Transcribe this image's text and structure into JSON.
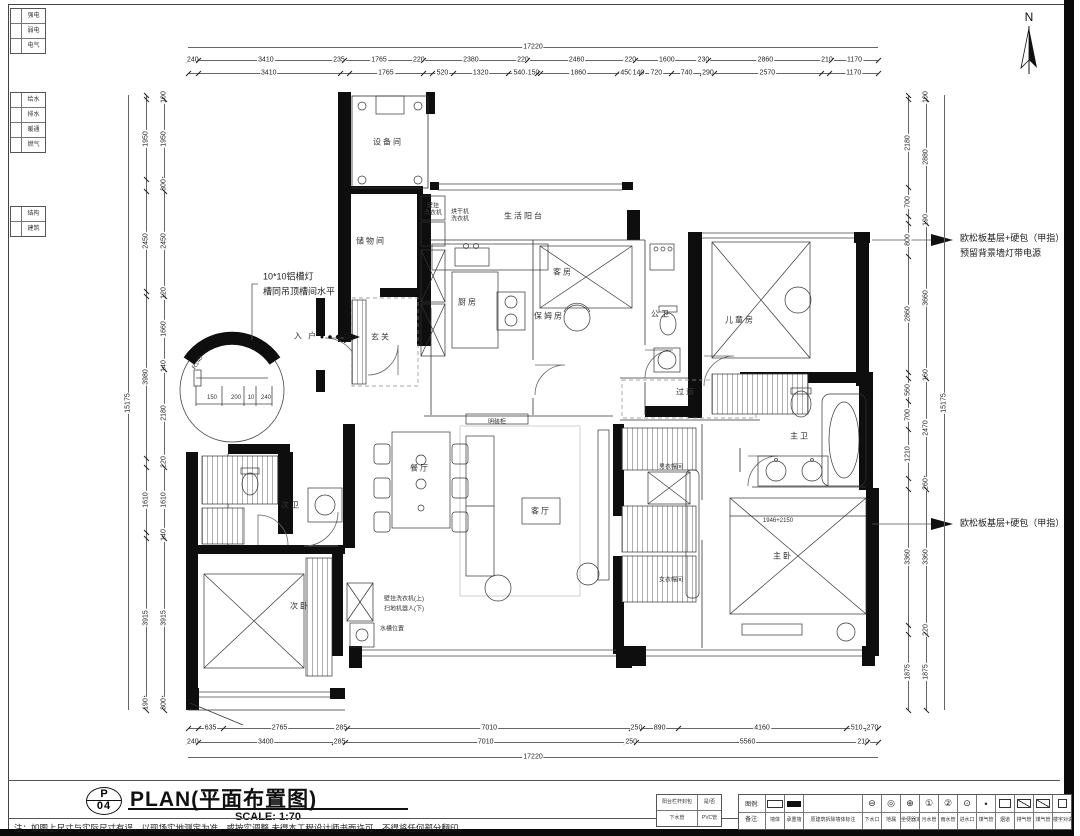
{
  "colors": {
    "paper": "#ffffff",
    "ink": "#111111",
    "line": "#555555"
  },
  "north": {
    "label": "N"
  },
  "title_block": {
    "sheet_letter": "P",
    "sheet_no": "04",
    "title": "PLAN(平面布置图)",
    "scale": "SCALE: 1:70"
  },
  "note": "注：如图上尺寸与实际尺寸有误，以现场实地测定为准，或按实调整.未得本工程设计师书面许可，不得将任何部分翻印。",
  "mini_table": {
    "rows": [
      [
        "阳台栏杆封包",
        "是/否"
      ],
      [
        "下水管",
        "PVC管"
      ]
    ]
  },
  "legend": {
    "prefix_top": "图例:",
    "prefix_bottom": "备注:",
    "items": [
      {
        "shape": "sw-wall-outline",
        "label": "墙体"
      },
      {
        "shape": "sw-wall-filled",
        "label": "承重墙"
      },
      {
        "wide": true,
        "label": "原建筑拆除墙体标注"
      },
      {
        "glyph": "⊖",
        "label": "下水口"
      },
      {
        "glyph": "◎",
        "label": "地漏"
      },
      {
        "glyph": "⊕",
        "label": "坐便器定位"
      },
      {
        "glyph": "①",
        "label": "污水管"
      },
      {
        "glyph": "②",
        "label": "雨水管"
      },
      {
        "glyph": "⊙",
        "label": "进水口"
      },
      {
        "glyph": "•",
        "label": "煤气管"
      },
      {
        "shape": "sw-rect",
        "label": "烟道"
      },
      {
        "shape": "sw-rect-diag",
        "label": "排气管"
      },
      {
        "shape": "sw-rect-diag",
        "label": "煤气管"
      },
      {
        "shape": "sw-square-dot",
        "glyph": "",
        "label": "楼宇对讲"
      }
    ]
  },
  "side_tables": [
    {
      "y": 8,
      "rows": [
        "强电",
        "弱电",
        "电气"
      ]
    },
    {
      "y": 92,
      "rows": [
        "给水",
        "排水",
        "暖通",
        "燃气"
      ]
    },
    {
      "y": 206,
      "rows": [
        "结构",
        "建筑"
      ]
    }
  ],
  "callouts": [
    {
      "x": 960,
      "y": 231,
      "lines": [
        "欧松板基层+硬包（甲指）",
        "预留背景墙灯带电源"
      ]
    },
    {
      "x": 960,
      "y": 516,
      "lines": [
        "欧松板基层+硬包（甲指）"
      ]
    }
  ],
  "plan_texts": [
    {
      "t": "设备间",
      "x": 388,
      "y": 142,
      "cls": "room"
    },
    {
      "t": "储物间",
      "x": 371,
      "y": 241,
      "cls": "room"
    },
    {
      "t": "生活阳台",
      "x": 524,
      "y": 216,
      "cls": "room"
    },
    {
      "t": "厨房",
      "x": 468,
      "y": 302,
      "cls": "room"
    },
    {
      "t": "玄关",
      "x": 381,
      "y": 337,
      "cls": "room"
    },
    {
      "t": "客房",
      "x": 563,
      "y": 272,
      "cls": "room"
    },
    {
      "t": "保姆房",
      "x": 549,
      "y": 316,
      "cls": "room"
    },
    {
      "t": "公卫",
      "x": 661,
      "y": 314,
      "cls": "room"
    },
    {
      "t": "儿童房",
      "x": 740,
      "y": 320,
      "cls": "room"
    },
    {
      "t": "过道",
      "x": 686,
      "y": 392,
      "cls": "room"
    },
    {
      "t": "次卫",
      "x": 291,
      "y": 505,
      "cls": "room"
    },
    {
      "t": "餐厅",
      "x": 420,
      "y": 468,
      "cls": "room"
    },
    {
      "t": "客厅",
      "x": 541,
      "y": 511,
      "cls": "room"
    },
    {
      "t": "明装柜",
      "x": 497,
      "y": 421,
      "cls": "tiny"
    },
    {
      "t": "男衣帽间",
      "x": 671,
      "y": 466,
      "cls": "tiny"
    },
    {
      "t": "女衣帽间",
      "x": 671,
      "y": 579,
      "cls": "tiny"
    },
    {
      "t": "主卫",
      "x": 800,
      "y": 436,
      "cls": "room"
    },
    {
      "t": "主卧",
      "x": 783,
      "y": 556,
      "cls": "room"
    },
    {
      "t": "次卧",
      "x": 300,
      "y": 606,
      "cls": "room"
    },
    {
      "t": "入 户",
      "x": 306,
      "y": 336,
      "cls": "room"
    },
    {
      "t": "壁挂",
      "x": 433,
      "y": 205,
      "cls": "tiny"
    },
    {
      "t": "洗衣机",
      "x": 433,
      "y": 212,
      "cls": "tiny"
    },
    {
      "t": "烘干机",
      "x": 460,
      "y": 211,
      "cls": "tiny"
    },
    {
      "t": "洗衣机",
      "x": 460,
      "y": 218,
      "cls": "tiny"
    },
    {
      "t": "壁挂洗衣机(上)",
      "x": 404,
      "y": 598,
      "cls": "tiny"
    },
    {
      "t": "扫地机器人(下)",
      "x": 404,
      "y": 608,
      "cls": "tiny"
    },
    {
      "t": "水槽位置",
      "x": 392,
      "y": 628,
      "cls": "tiny"
    },
    {
      "t": "1946+2150",
      "x": 778,
      "y": 521,
      "cls": "tiny"
    },
    {
      "t": "150",
      "x": 212,
      "y": 398,
      "cls": "tiny"
    },
    {
      "t": "200",
      "x": 236,
      "y": 398,
      "cls": "tiny"
    },
    {
      "t": "10",
      "x": 251,
      "y": 398,
      "cls": "tiny"
    },
    {
      "t": "240",
      "x": 266,
      "y": 398,
      "cls": "tiny"
    },
    {
      "t": "R140",
      "x": 198,
      "y": 363,
      "cls": "tiny",
      "rot": -55
    },
    {
      "t": "10*10铝槽灯",
      "x": 263,
      "y": 276,
      "cls": "anno"
    },
    {
      "t": "槽同吊顶槽间水平",
      "x": 263,
      "y": 291,
      "cls": "anno"
    }
  ],
  "dims": {
    "top_total": {
      "total": "17220"
    },
    "top_a": {
      "segs": [
        [
          240,
          "240"
        ],
        [
          3410,
          "3410"
        ],
        [
          235,
          "235"
        ],
        [
          1765,
          "1765"
        ],
        [
          220,
          "220"
        ],
        [
          2380,
          "2380"
        ],
        [
          220,
          "220"
        ],
        [
          2460,
          "2460"
        ],
        [
          220,
          "220"
        ],
        [
          1600,
          "1600"
        ],
        [
          230,
          "230"
        ],
        [
          2860,
          "2860"
        ],
        [
          210,
          "210"
        ],
        [
          1170,
          "1170"
        ]
      ]
    },
    "top_b": {
      "segs": [
        [
          240,
          ""
        ],
        [
          3410,
          "3410"
        ],
        [
          235,
          ""
        ],
        [
          1765,
          "1765"
        ],
        [
          220,
          ""
        ],
        [
          520,
          "520"
        ],
        [
          1320,
          "1320"
        ],
        [
          540,
          "540"
        ],
        [
          150,
          "150"
        ],
        [
          70,
          ""
        ],
        [
          1860,
          "1860"
        ],
        [
          450,
          "450"
        ],
        [
          140,
          "140"
        ],
        [
          720,
          "720"
        ],
        [
          740,
          "740"
        ],
        [
          290,
          "290"
        ],
        [
          2570,
          "2570"
        ],
        [
          210,
          ""
        ],
        [
          1170,
          "1170"
        ]
      ]
    },
    "bot_a": {
      "segs": [
        [
          240,
          ""
        ],
        [
          635,
          "635"
        ],
        [
          2765,
          "2765"
        ],
        [
          285,
          "285"
        ],
        [
          7010,
          "7010"
        ],
        [
          250,
          "250"
        ],
        [
          890,
          "890"
        ],
        [
          4160,
          "4160"
        ],
        [
          510,
          "510"
        ],
        [
          270,
          "270"
        ]
      ]
    },
    "bot_b": {
      "segs": [
        [
          240,
          "240"
        ],
        [
          3400,
          "3400"
        ],
        [
          285,
          "285"
        ],
        [
          7010,
          "7010"
        ],
        [
          250,
          "250"
        ],
        [
          5560,
          "5560"
        ],
        [
          210,
          "210"
        ],
        [
          265,
          ""
        ]
      ]
    },
    "bot_total": {
      "total": "17220"
    },
    "left_total": {
      "total": "15175"
    },
    "left_outer": {
      "segs": [
        [
          100,
          ""
        ],
        [
          1950,
          "1950"
        ],
        [
          300,
          ""
        ],
        [
          2450,
          "2450"
        ],
        [
          120,
          ""
        ],
        [
          3980,
          "3980"
        ],
        [
          220,
          ""
        ],
        [
          1610,
          "1610"
        ],
        [
          140,
          ""
        ],
        [
          3915,
          "3915"
        ],
        [
          300,
          "190"
        ]
      ]
    },
    "left_inner": {
      "segs": [
        [
          100,
          "100"
        ],
        [
          1950,
          "1950"
        ],
        [
          300,
          "300"
        ],
        [
          2450,
          "2450"
        ],
        [
          120,
          "120"
        ],
        [
          1660,
          "1660"
        ],
        [
          140,
          "140"
        ],
        [
          2180,
          "2180"
        ],
        [
          220,
          "220"
        ],
        [
          1610,
          "1610"
        ],
        [
          140,
          "140"
        ],
        [
          3915,
          "3915"
        ],
        [
          300,
          "300"
        ]
      ]
    },
    "right_inner": {
      "segs": [
        [
          100,
          ""
        ],
        [
          2180,
          "2180"
        ],
        [
          700,
          "700"
        ],
        [
          190,
          ""
        ],
        [
          800,
          "800"
        ],
        [
          2860,
          "2860"
        ],
        [
          160,
          ""
        ],
        [
          560,
          "560"
        ],
        [
          700,
          "700"
        ],
        [
          1210,
          "1210"
        ],
        [
          260,
          ""
        ],
        [
          3360,
          "3360"
        ],
        [
          220,
          ""
        ],
        [
          1875,
          "1875"
        ]
      ]
    },
    "right_outer": {
      "segs": [
        [
          100,
          "100"
        ],
        [
          2880,
          "2880"
        ],
        [
          190,
          "190"
        ],
        [
          3660,
          "3660"
        ],
        [
          160,
          "160"
        ],
        [
          2470,
          "2470"
        ],
        [
          260,
          "260"
        ],
        [
          3360,
          "3360"
        ],
        [
          220,
          "220"
        ],
        [
          1875,
          "1875"
        ]
      ]
    },
    "right_total": {
      "total": "15175"
    }
  }
}
